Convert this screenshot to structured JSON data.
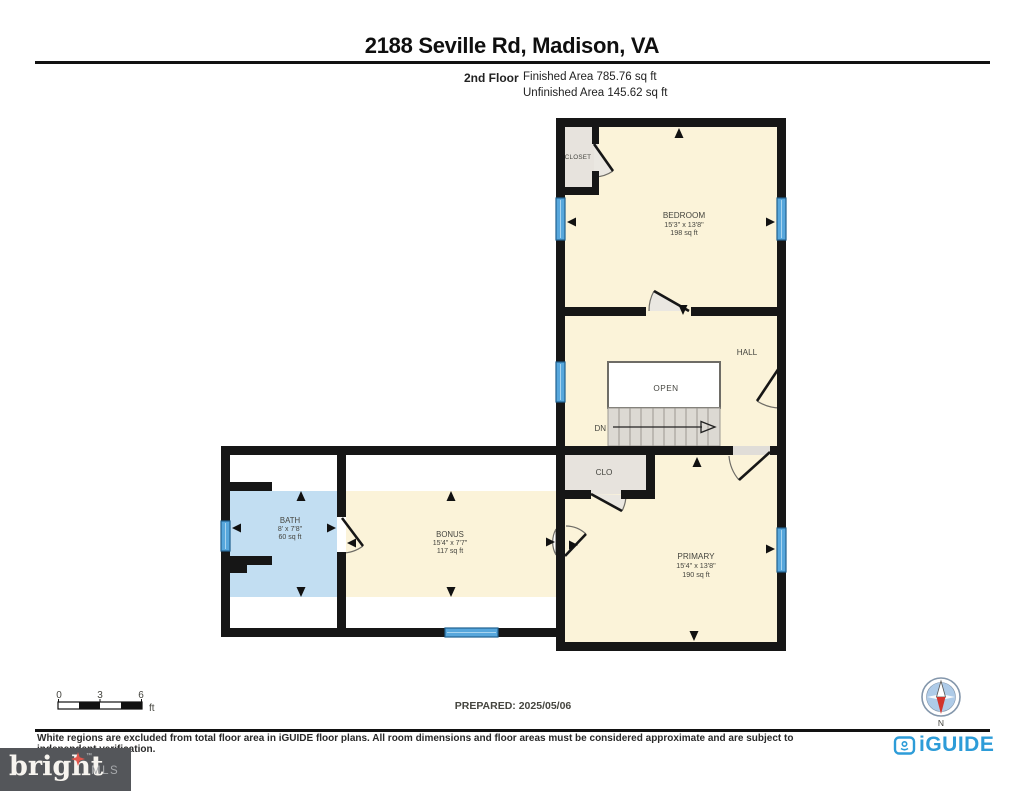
{
  "header": {
    "title": "2188 Seville Rd, Madison, VA",
    "floor_label": "2nd Floor",
    "finished_area": "Finished Area 785.76 sq ft",
    "unfinished_area": "Unfinished Area 145.62 sq ft"
  },
  "rooms": {
    "bedroom": {
      "name": "BEDROOM",
      "dimensions": "15'3\" x 13'8\"",
      "area": "198 sq ft"
    },
    "closet": {
      "name": "CLOSET"
    },
    "hall": {
      "name": "HALL"
    },
    "open_label": "OPEN",
    "stairs_dn": "DN",
    "clo": {
      "name": "CLO"
    },
    "primary": {
      "name": "PRIMARY",
      "dimensions": "15'4\" x 13'8\"",
      "area": "190 sq ft"
    },
    "bath": {
      "name": "BATH",
      "dimensions": "8' x 7'8\"",
      "area": "60 sq ft"
    },
    "bonus": {
      "name": "BONUS",
      "dimensions": "15'4\" x 7'7\"",
      "area": "117 sq ft"
    }
  },
  "scale_bar": {
    "t0": "0",
    "t3": "3",
    "t6": "6",
    "unit": "ft"
  },
  "footer": {
    "prepared": "PREPARED: 2025/05/06",
    "disclaimer": "White regions are excluded from total floor area in iGUIDE floor plans. All room dimensions and floor areas must be considered approximate and are subject to independent verification.",
    "compass_n": "N"
  },
  "branding": {
    "iguide": "iGUIDE",
    "bright": "bright",
    "mls": "MLS",
    "tm": "™"
  },
  "colors": {
    "finished_fill": "#FBF3D9",
    "bath_fill": "#C2DEF2",
    "closet_fill": "#E7E3DD",
    "window_blue": "#57A7DC",
    "wall_black": "#161616",
    "iguide_blue": "#2D9CD8",
    "bright_bg": "#54565A",
    "compass_red": "#D2342C"
  }
}
